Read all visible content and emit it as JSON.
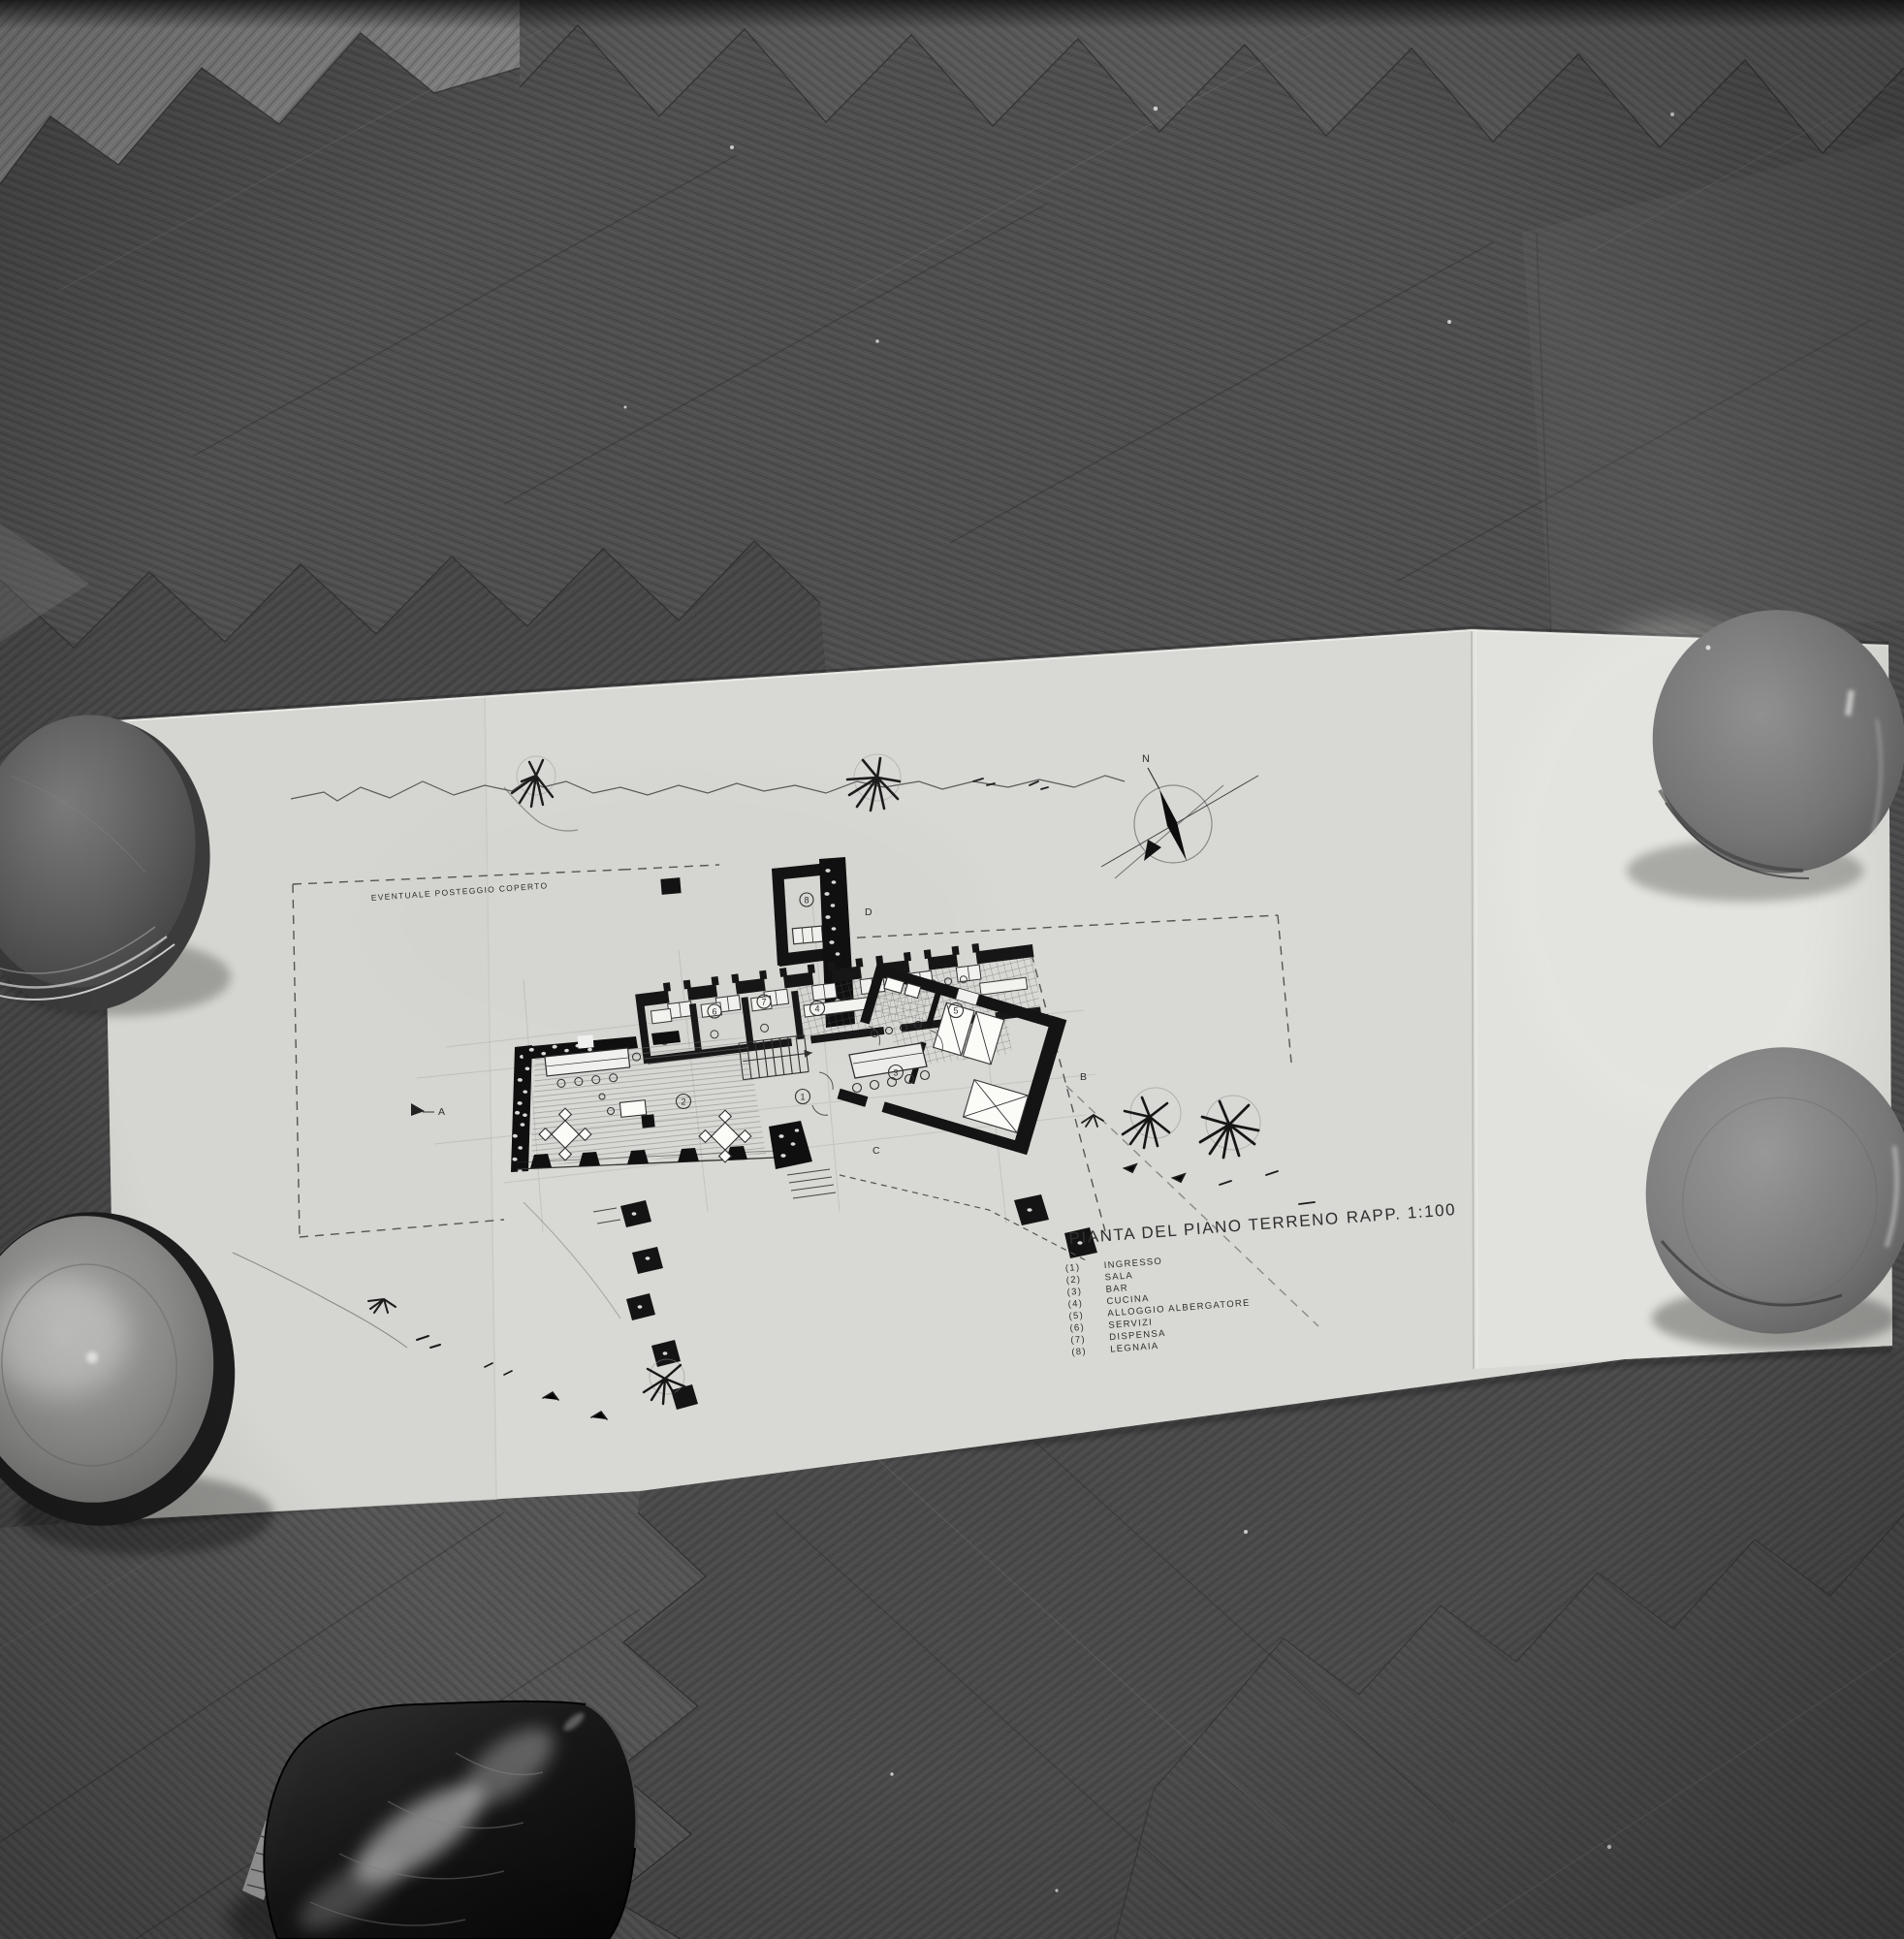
{
  "photo": {
    "drawing": {
      "title": "PIANTA DEL PIANO TERRENO",
      "scale": "RAPP. 1:100",
      "area_label": "EVENTUALE POSTEGGIO COPERTO",
      "compass_north": "N",
      "legend": {
        "items": [
          {
            "num": "(1)",
            "label": "INGRESSO"
          },
          {
            "num": "(2)",
            "label": "SALA"
          },
          {
            "num": "(3)",
            "label": "BAR"
          },
          {
            "num": "(4)",
            "label": "CUCINA"
          },
          {
            "num": "(5)",
            "label": "ALLOGGIO ALBERGATORE"
          },
          {
            "num": "(6)",
            "label": "SERVIZI"
          },
          {
            "num": "(7)",
            "label": "DISPENSA"
          },
          {
            "num": "(8)",
            "label": "LEGNAIA"
          }
        ]
      },
      "rooms": [
        "1",
        "2",
        "3",
        "4",
        "5",
        "6",
        "7",
        "8"
      ],
      "sections": {
        "a": "A",
        "b": "B",
        "c": "C",
        "d": "D"
      }
    },
    "colors": {
      "floor_dark": "#4f4f4f",
      "paper": "#d8d8d4",
      "ink": "#2e2e2e"
    }
  }
}
